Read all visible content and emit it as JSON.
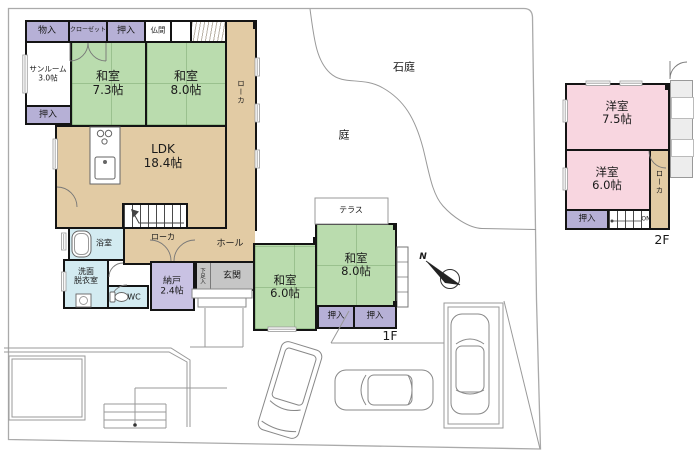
{
  "colors": {
    "tatami_green": "#badcae",
    "wood_tan": "#e2cba4",
    "closet_lavender": "#b6b0d6",
    "storage_purple": "#c9c2e3",
    "wet_cyan": "#d3ebf1",
    "western_pink": "#f8d6e0",
    "entrance_gray": "#c6c6c6",
    "wall_black": "#141414",
    "boundary_gray": "#aaaaaa"
  },
  "site": {
    "rock_garden": "石庭",
    "garden": "庭",
    "compass_north": "N"
  },
  "f1": {
    "floor_label": "1F",
    "monoiri": "物入",
    "closet": "クローゼット",
    "oshiire_top": "押入",
    "butsuma": "仏間",
    "sunroom": {
      "name": "サンルーム",
      "area": "3.0帖"
    },
    "oshiire_left": "押入",
    "washitsu73": {
      "name": "和室",
      "area": "7.3帖"
    },
    "washitsu80a": {
      "name": "和室",
      "area": "8.0帖"
    },
    "roka_right": "ローカ",
    "ldk": {
      "name": "LDK",
      "area": "18.4帖"
    },
    "roka_mid": "ローカ",
    "hall": "ホール",
    "bath": "浴室",
    "senmen": "洗面",
    "datsui": "脱衣室",
    "wc": "WC",
    "nando": {
      "name": "納戸",
      "area": "2.4帖"
    },
    "genkan": "玄関",
    "gesokuiri": "下足入",
    "terrace": "テラス",
    "washitsu60": {
      "name": "和室",
      "area": "6.0帖"
    },
    "washitsu80b": {
      "name": "和室",
      "area": "8.0帖"
    },
    "oshiire_b1": "押入",
    "oshiire_b2": "押入"
  },
  "f2": {
    "floor_label": "2F",
    "yoshitsu75": {
      "name": "洋室",
      "area": "7.5帖"
    },
    "yoshitsu60": {
      "name": "洋室",
      "area": "6.0帖"
    },
    "roka": "ローカ",
    "oshiire": "押入",
    "stairs_up": "ON"
  }
}
